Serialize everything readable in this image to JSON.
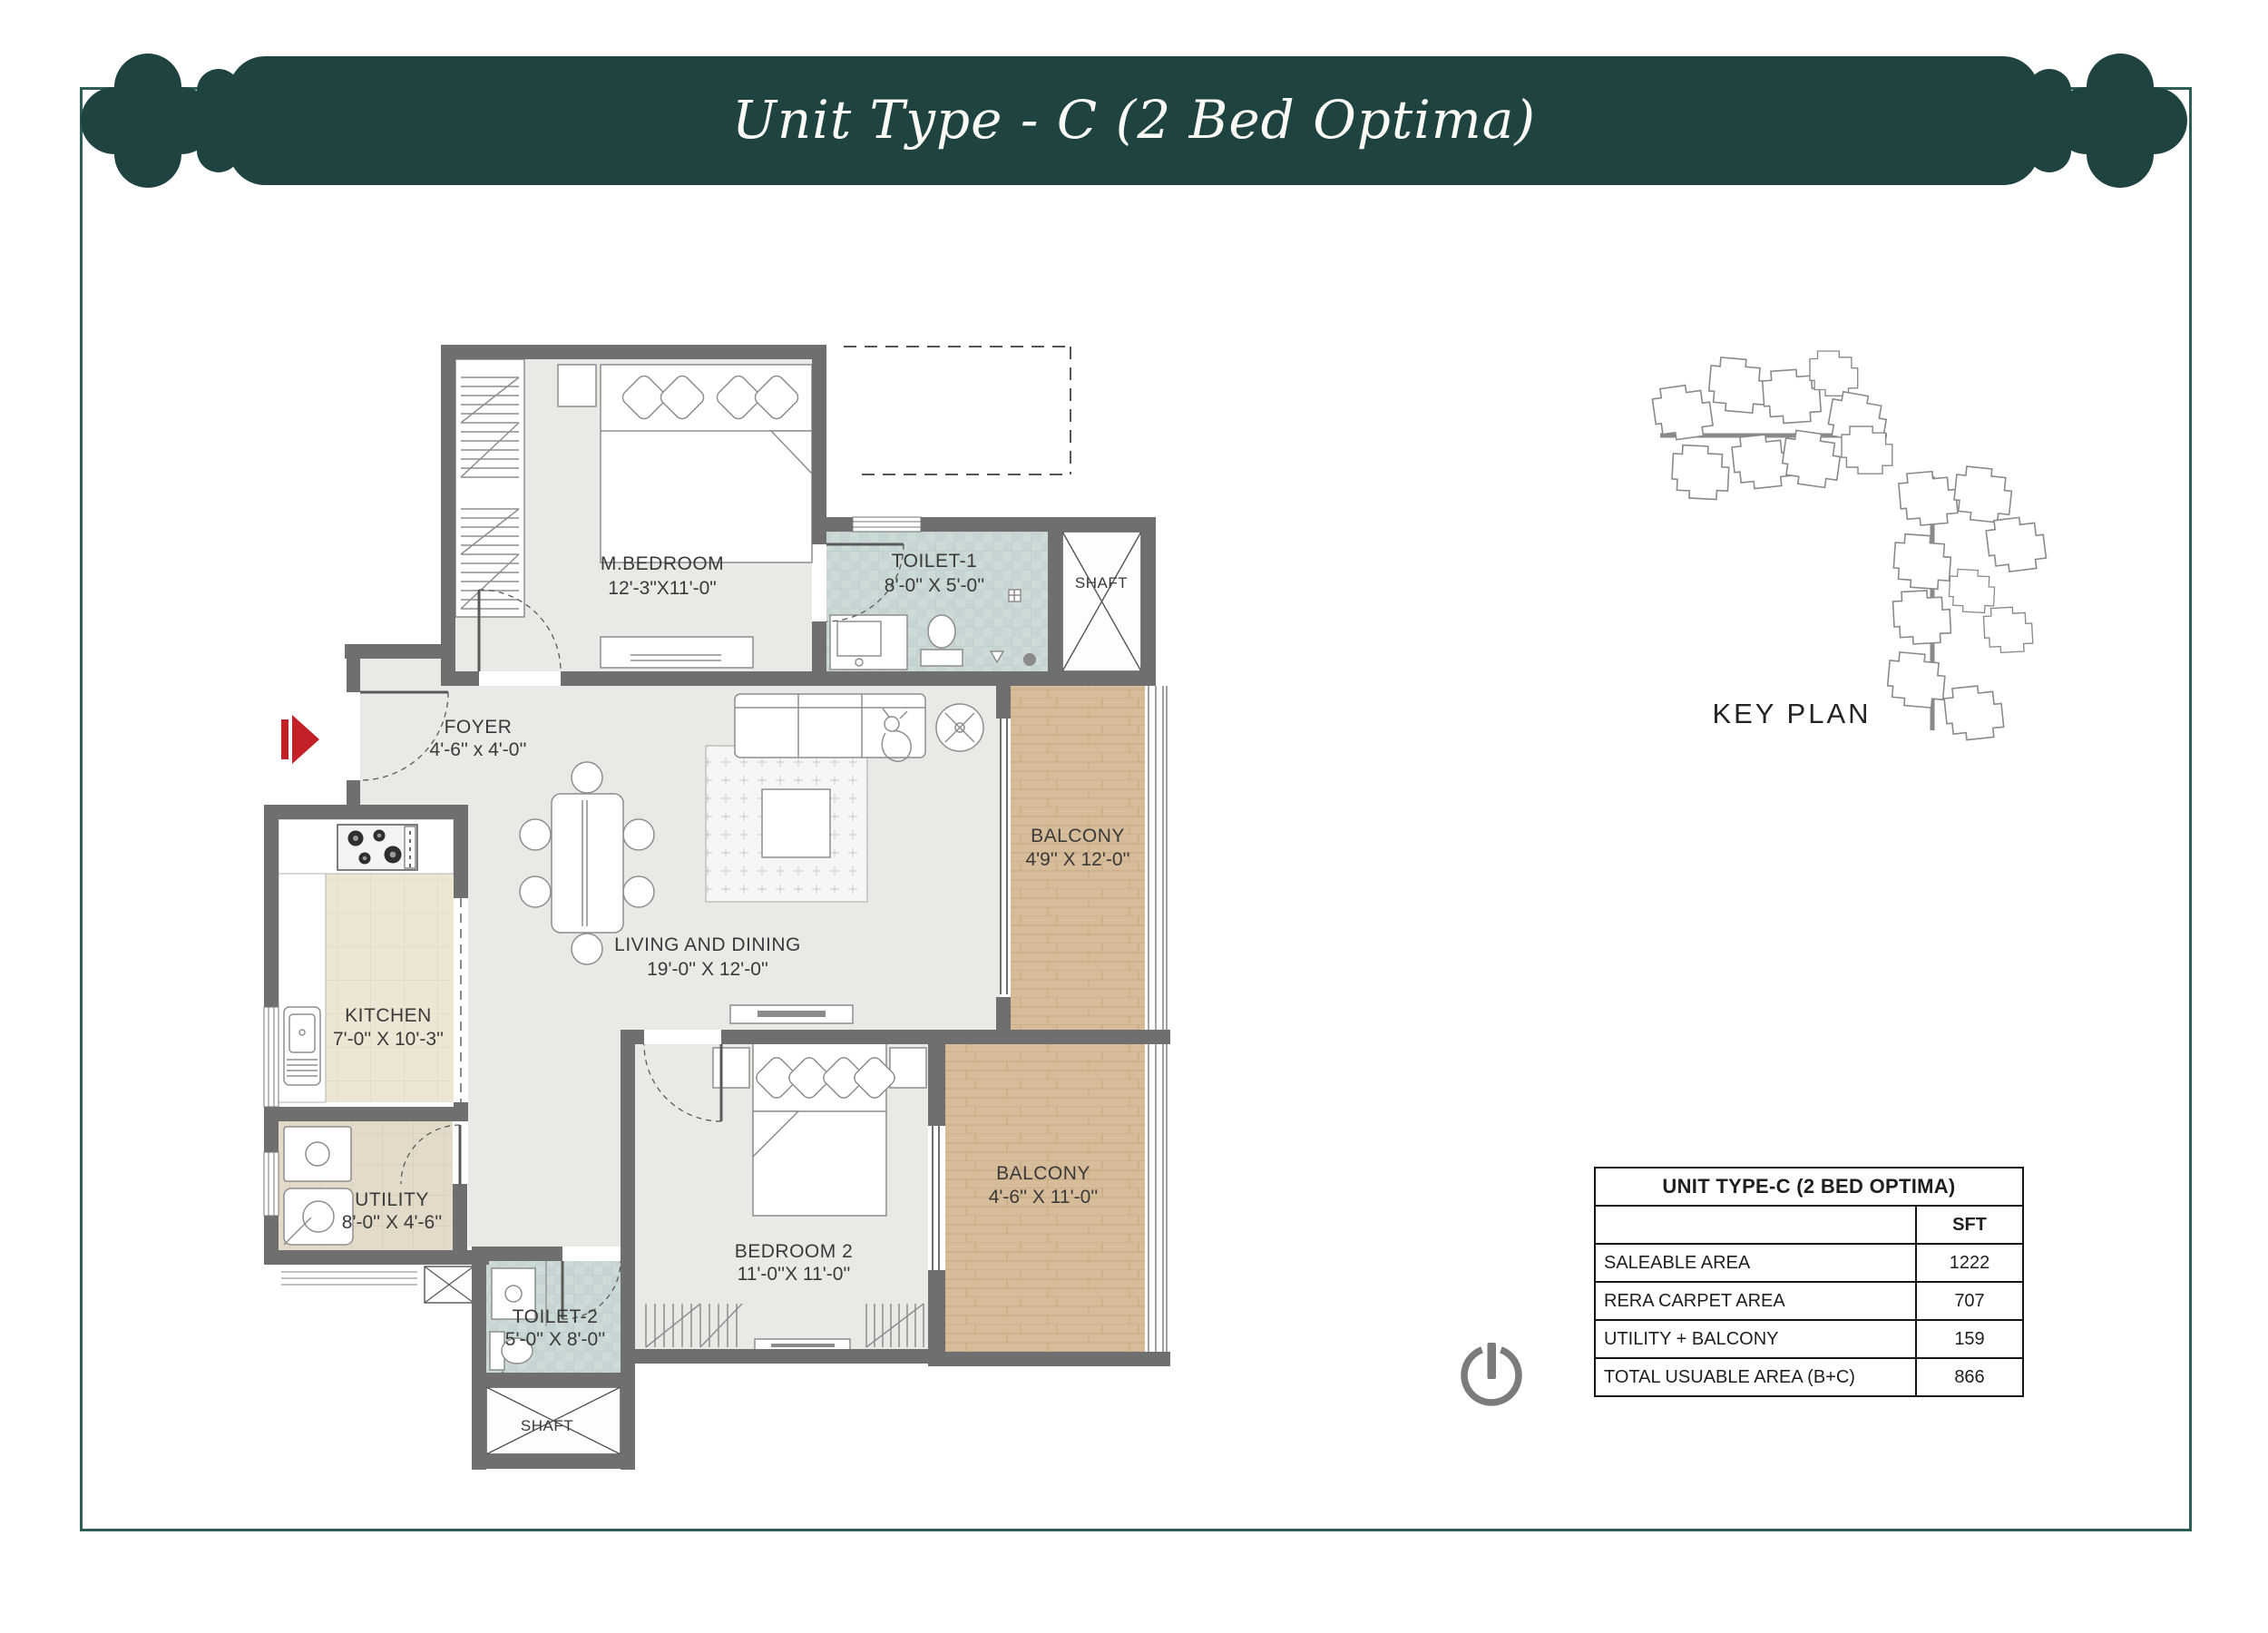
{
  "header": {
    "title": "Unit Type - C (2 Bed Optima)"
  },
  "rooms": {
    "mbedroom": {
      "name": "M.BEDROOM",
      "dims": "12'-3\"X11'-0\""
    },
    "toilet1": {
      "name": "TOILET-1",
      "dims": "8'-0'' X 5'-0''"
    },
    "shaft": {
      "name": "SHAFT"
    },
    "foyer": {
      "name": "FOYER",
      "dims": "4'-6'' x 4'-0''"
    },
    "living": {
      "name": "LIVING AND DINING",
      "dims": "19'-0'' X 12'-0''"
    },
    "balcony1": {
      "name": "BALCONY",
      "dims": "4'9'' X 12'-0''"
    },
    "kitchen": {
      "name": "KITCHEN",
      "dims": "7'-0'' X 10'-3''"
    },
    "utility": {
      "name": "UTILITY",
      "dims": "8'-0'' X 4'-6''"
    },
    "toilet2": {
      "name": "TOILET-2",
      "dims": "5'-0'' X 8'-0''"
    },
    "bedroom2": {
      "name": "BEDROOM 2",
      "dims": "11'-0''X 11'-0''"
    },
    "balcony2": {
      "name": "BALCONY",
      "dims": "4'-6'' X 11'-0''"
    }
  },
  "key_plan": {
    "label": "KEY PLAN"
  },
  "area_table": {
    "title": "UNIT TYPE-C (2 BED OPTIMA)",
    "unit_column": "SFT",
    "rows": [
      {
        "label": "SALEABLE AREA",
        "value": "1222"
      },
      {
        "label": "RERA CARPET AREA",
        "value": "707"
      },
      {
        "label": "UTILITY + BALCONY",
        "value": "159"
      },
      {
        "label": "TOTAL USUABLE AREA (B+C)",
        "value": "866"
      }
    ]
  },
  "colors": {
    "banner": "#1f4340",
    "frame_border": "#2e5e57",
    "wall": "#6f6f6f",
    "entry_arrow": "#c32127",
    "key_unit_highlight": "#a2661f"
  }
}
